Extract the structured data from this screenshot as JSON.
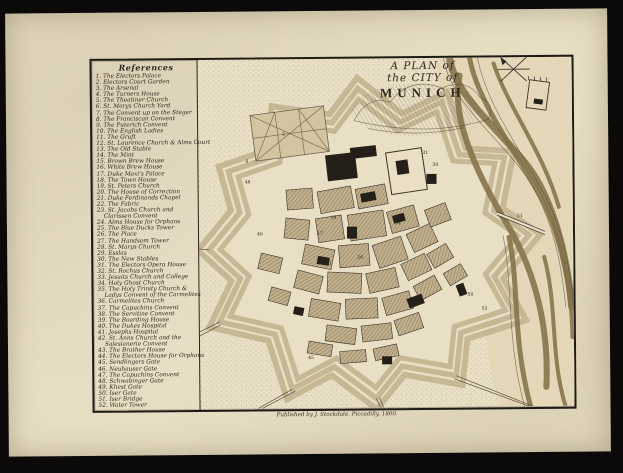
{
  "references": {
    "title": "References",
    "items": [
      {
        "n": "1",
        "label": "The Electors Palace"
      },
      {
        "n": "2",
        "label": "Electors Court Garden"
      },
      {
        "n": "3",
        "label": "The Arsenal"
      },
      {
        "n": "4",
        "label": "The Turners House"
      },
      {
        "n": "5",
        "label": "The Theatiner Church"
      },
      {
        "n": "6",
        "label": "St. Marys Church Yard"
      },
      {
        "n": "7",
        "label": "The Convent up on the Steger"
      },
      {
        "n": "8",
        "label": "The Franciscan Convent"
      },
      {
        "n": "9",
        "label": "The Puterich Convent"
      },
      {
        "n": "10",
        "label": "The English Ladies"
      },
      {
        "n": "11",
        "label": "The Gruft"
      },
      {
        "n": "12",
        "label": "St. Laurence Church & Alms Court"
      },
      {
        "n": "13",
        "label": "The Old Stable"
      },
      {
        "n": "14",
        "label": "The Mint"
      },
      {
        "n": "15",
        "label": "Brown Brew House"
      },
      {
        "n": "16",
        "label": "White Brew House"
      },
      {
        "n": "17",
        "label": "Duke Maxi's Palace"
      },
      {
        "n": "18",
        "label": "The Town House"
      },
      {
        "n": "19",
        "label": "St. Peters Church"
      },
      {
        "n": "20",
        "label": "The House of Correction"
      },
      {
        "n": "21",
        "label": "Duke Ferdinands Chapel"
      },
      {
        "n": "22",
        "label": "The Fabric"
      },
      {
        "n": "23",
        "label": "St. Jacobs Church and",
        "label2": "Clarissen Convent"
      },
      {
        "n": "24",
        "label": "Alms House for Orphans"
      },
      {
        "n": "25",
        "label": "The Blue Ducks Tower"
      },
      {
        "n": "26",
        "label": "The Place"
      },
      {
        "n": "27",
        "label": "The Handsom Tower"
      },
      {
        "n": "28",
        "label": "St. Marys Church"
      },
      {
        "n": "29",
        "label": "Esslas"
      },
      {
        "n": "30",
        "label": "The New Stables"
      },
      {
        "n": "31",
        "label": "The Electors Opera House"
      },
      {
        "n": "32",
        "label": "St. Rochus Church"
      },
      {
        "n": "33",
        "label": "Jesuits Church and College"
      },
      {
        "n": "34",
        "label": "Holy Ghost Church"
      },
      {
        "n": "35",
        "label": "The Holy Trinity Church &",
        "label2": "Ladys Convent of the Carmelites"
      },
      {
        "n": "36",
        "label": "Carmelites Church"
      },
      {
        "n": "37",
        "label": "The Capuchins Convent"
      },
      {
        "n": "38",
        "label": "The Servitine Convent"
      },
      {
        "n": "39",
        "label": "The Boarding House"
      },
      {
        "n": "40",
        "label": "The Dukes Hospital"
      },
      {
        "n": "41",
        "label": "Josephs Hospital"
      },
      {
        "n": "42",
        "label": "St. Anns Church and the",
        "label2": "Salesianerie Convent"
      },
      {
        "n": "43",
        "label": "The Brother House"
      },
      {
        "n": "44",
        "label": "The Electors House for Orphans"
      },
      {
        "n": "45",
        "label": "Sendlingers Gate"
      },
      {
        "n": "46",
        "label": "Neuhauser Gate"
      },
      {
        "n": "47",
        "label": "The Capuchins Convent"
      },
      {
        "n": "48",
        "label": "Schwabinger Gate"
      },
      {
        "n": "49",
        "label": "Khest Gate"
      },
      {
        "n": "50",
        "label": "Iser Gate"
      },
      {
        "n": "51",
        "label": "Iser Bridge"
      },
      {
        "n": "52",
        "label": "Water Tower"
      }
    ]
  },
  "cartouche": {
    "line1": "A PLAN of",
    "line2": "the CITY of",
    "line3": "MUNICH"
  },
  "imprint": "Published by J. Stockdale, Piccadilly, 1800.",
  "map_numbers": [
    {
      "n": "48",
      "x": 46,
      "y": 124
    },
    {
      "n": "4",
      "x": 47,
      "y": 103
    },
    {
      "n": "2",
      "x": 84,
      "y": 76
    },
    {
      "n": "1",
      "x": 140,
      "y": 106
    },
    {
      "n": "3",
      "x": 205,
      "y": 112
    },
    {
      "n": "31",
      "x": 224,
      "y": 96
    },
    {
      "n": "30",
      "x": 234,
      "y": 108
    },
    {
      "n": "5",
      "x": 148,
      "y": 120
    },
    {
      "n": "28",
      "x": 168,
      "y": 142
    },
    {
      "n": "14",
      "x": 132,
      "y": 160
    },
    {
      "n": "17",
      "x": 118,
      "y": 176
    },
    {
      "n": "19",
      "x": 152,
      "y": 178
    },
    {
      "n": "34",
      "x": 196,
      "y": 166
    },
    {
      "n": "26",
      "x": 158,
      "y": 200
    },
    {
      "n": "33",
      "x": 126,
      "y": 206
    },
    {
      "n": "40",
      "x": 216,
      "y": 246
    },
    {
      "n": "46",
      "x": 58,
      "y": 176
    },
    {
      "n": "45",
      "x": 108,
      "y": 300
    },
    {
      "n": "50",
      "x": 268,
      "y": 238
    },
    {
      "n": "51",
      "x": 318,
      "y": 160
    },
    {
      "n": "52",
      "x": 282,
      "y": 252
    }
  ],
  "colors": {
    "scan_bg": "#0b0a08",
    "paper": "#e7ddc3",
    "ink": "#2e281f",
    "city_block": "#c2b08d",
    "solid_building": "#241f18",
    "river": "#837249",
    "garden": "#d3c5a2",
    "stipple": "#7e7055"
  }
}
